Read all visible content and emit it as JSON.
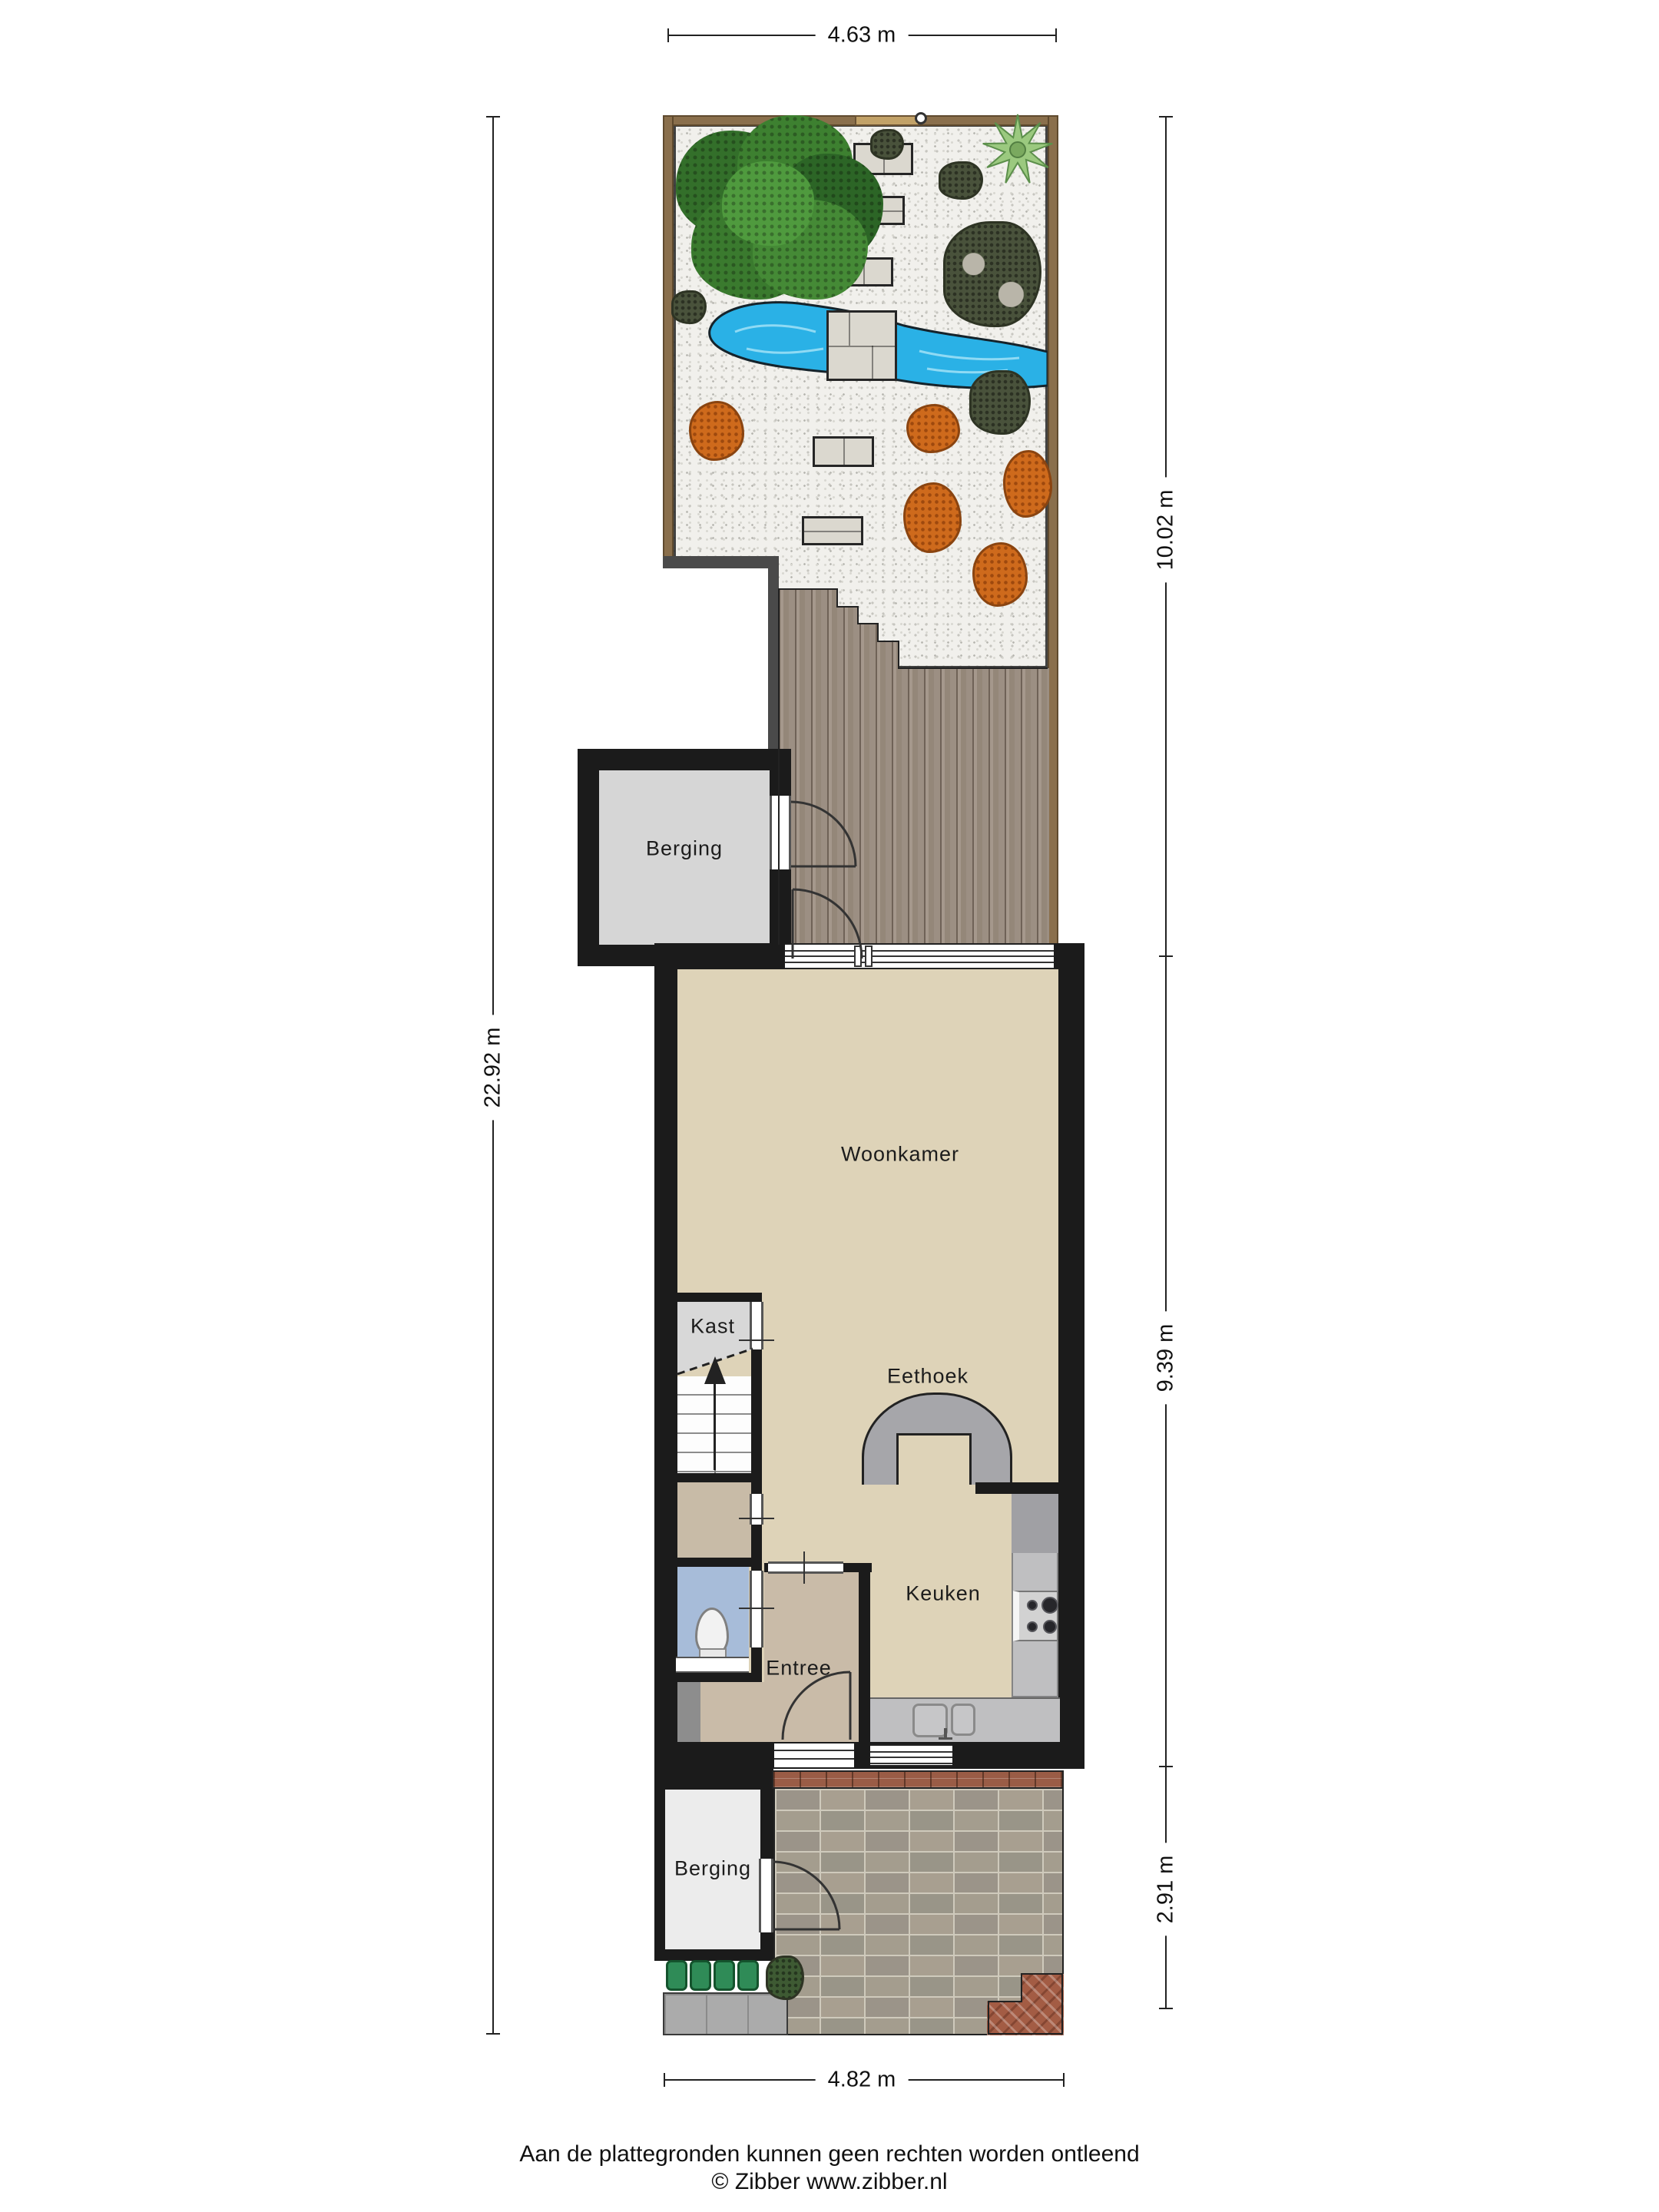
{
  "rooms": {
    "berging_upper": "Berging",
    "woonkamer": "Woonkamer",
    "kast": "Kast",
    "eethoek": "Eethoek",
    "keuken": "Keuken",
    "entree": "Entree",
    "berging_lower": "Berging"
  },
  "dimensions": {
    "top": "4.63 m",
    "left": "22.92 m",
    "right_top": "10.02 m",
    "right_middle": "9.39 m",
    "right_bottom": "2.91 m",
    "bottom": "4.82 m"
  },
  "footer": {
    "disclaimer": "Aan de plattegronden kunnen geen rechten worden ontleend",
    "credit": "© Zibber www.zibber.nl"
  },
  "colors": {
    "wall": "#1b1b1b",
    "retaining_wall": "#4a4a4a",
    "floor_living": "#ded3b8",
    "floor_hall": "#c8bba7",
    "floor_entree": "#c9bba8",
    "floor_kast": "#d8d8d8",
    "floor_berging_upper": "#d6d6d6",
    "floor_berging_lower": "#ececec",
    "floor_toilet": "#a7bcd9",
    "counter": "#bfbfc1",
    "arch": "#a6a6aa",
    "pond": "#2ab1e6",
    "deck_wood": "#998b80",
    "fence": "#8a6f4c",
    "gravel": "#f1f0ec",
    "tree": "#3a7d30",
    "palm": "#9bc97f",
    "dark_shrub": "#49523b",
    "orange_shrub": "#ce6a1c",
    "brick_red": "#9a5c46",
    "paving_grey": "#a09a8e",
    "bench_green": "#2f8b57"
  }
}
